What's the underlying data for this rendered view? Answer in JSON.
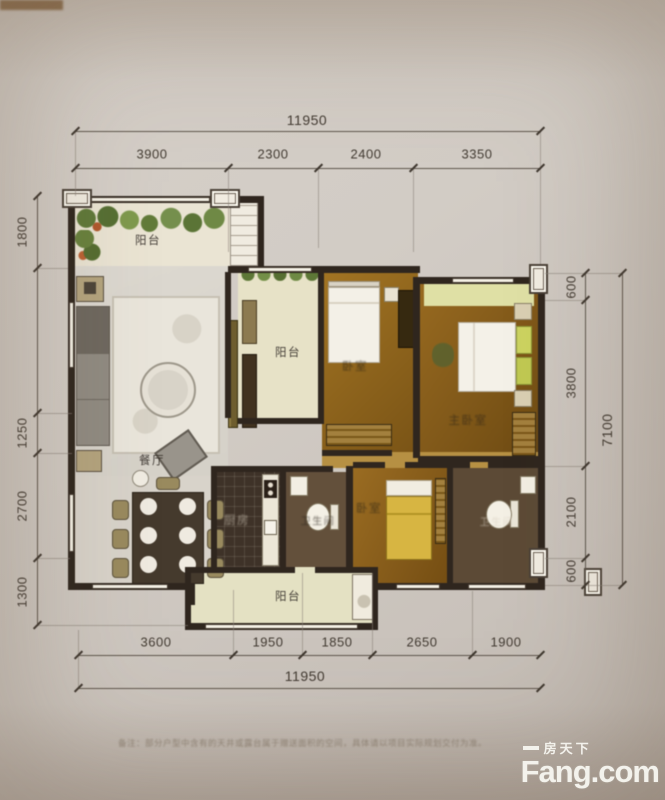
{
  "floorplan": {
    "rooms": {
      "balcony_top": "阳台",
      "balcony_mid": "阳台",
      "balcony_bottom": "阳台",
      "dining": "餐厅",
      "kitchen": "厨房",
      "bathroom_1": "卫生间",
      "bathroom_2": "卫生间",
      "bedroom_top": "卧室",
      "bedroom_master": "主卧室",
      "bedroom_bottom": "卧室"
    },
    "dimensions": {
      "top_total": "11950",
      "top_segments": [
        "3900",
        "2300",
        "2400",
        "3350"
      ],
      "bottom_segments": [
        "3600",
        "1950",
        "1850",
        "2650",
        "1900"
      ],
      "bottom_total": "11950",
      "left_segments": [
        "1800",
        "1250",
        "2700",
        "1300"
      ],
      "right_segments": [
        "600",
        "3800",
        "2100",
        "600"
      ],
      "right_total": "7100"
    }
  },
  "note": "备注：部分户型中含有的天井或露台属于赠送面积的空间，具体请以项目实际规划交付为准。",
  "watermark": {
    "site_cn": "房天下",
    "site_en": "Fang.com"
  }
}
